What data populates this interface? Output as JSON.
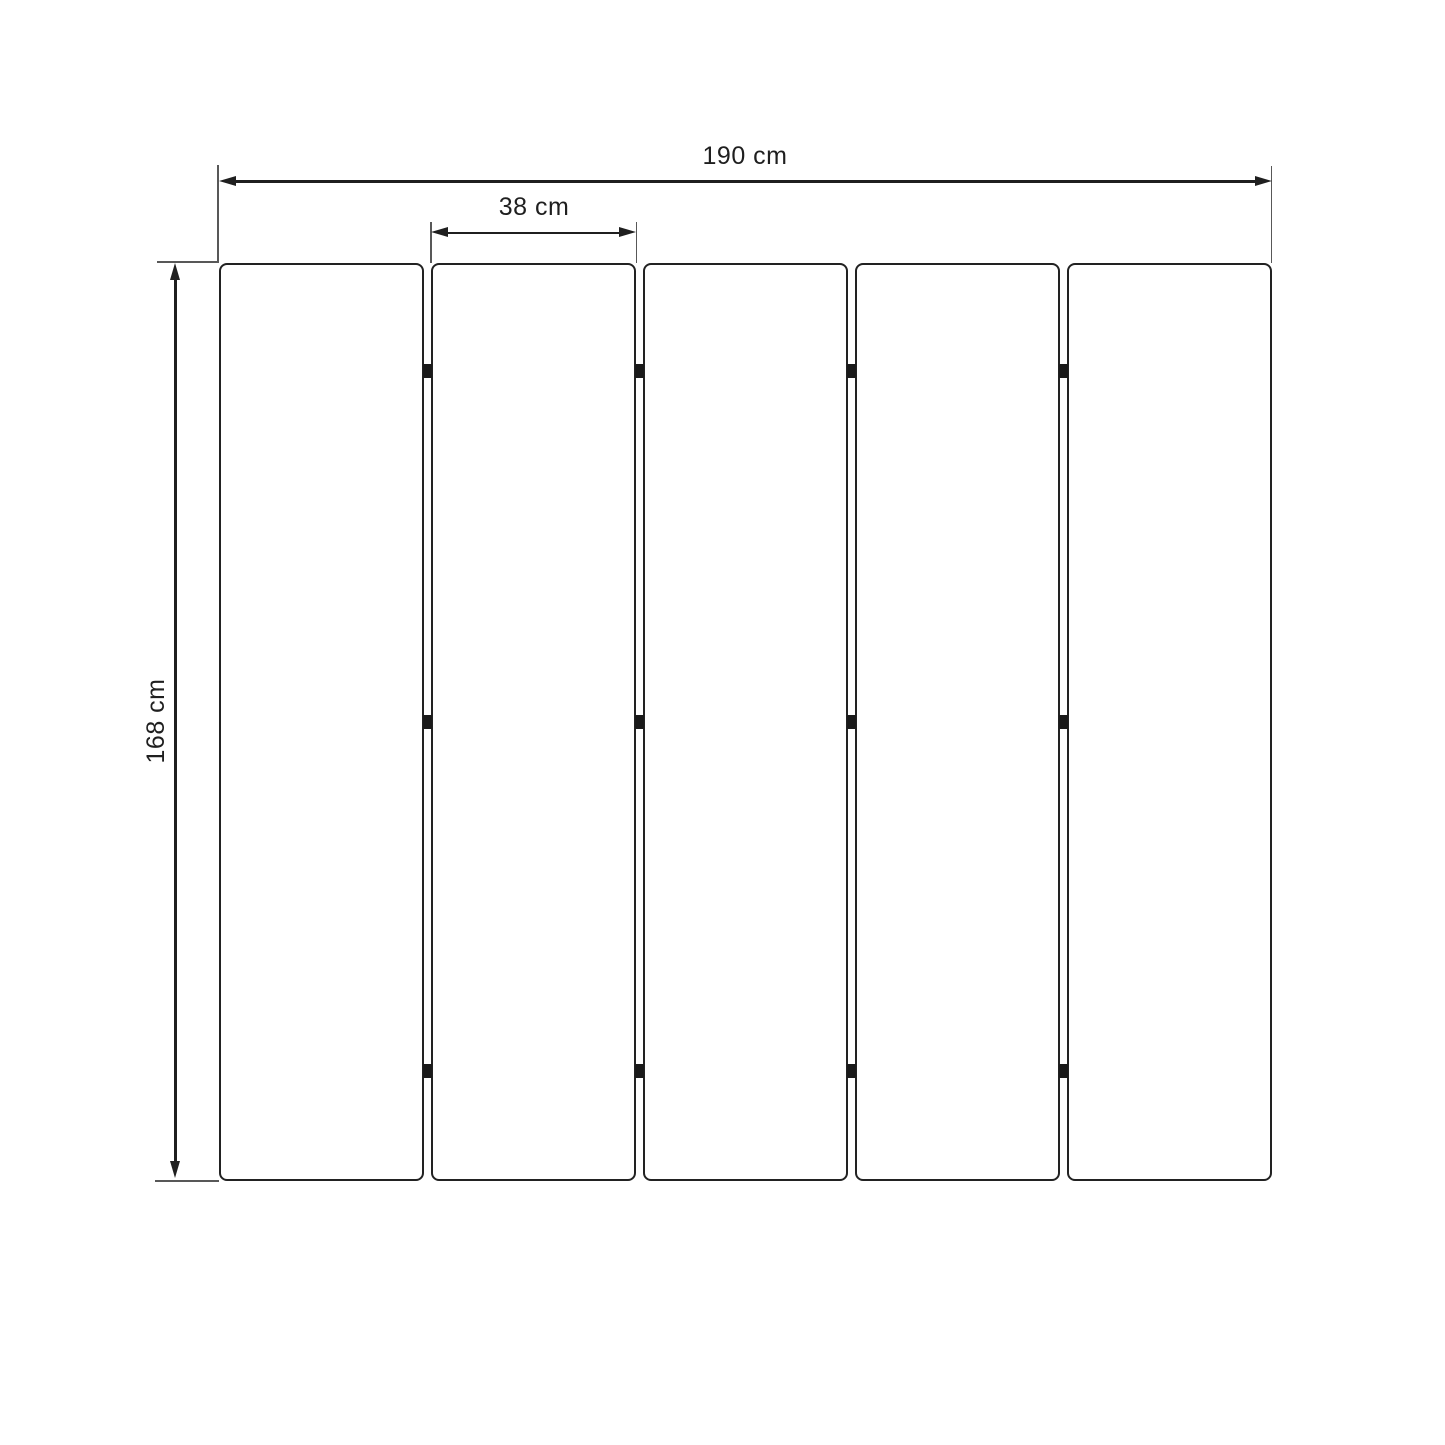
{
  "diagram": {
    "type": "panel-layout-dimension-drawing",
    "panel_count": 5,
    "hinge_rows": 3,
    "dimensions": {
      "total_width": {
        "label": "190 cm",
        "value": 190,
        "unit": "cm"
      },
      "panel_width": {
        "label": "38 cm",
        "value": 38,
        "unit": "cm"
      },
      "height": {
        "label": "168 cm",
        "value": 168,
        "unit": "cm"
      }
    },
    "colors": {
      "background": "#ffffff",
      "panel_border": "#222222",
      "dimension_line": "#1f1f1f",
      "extension_line": "#585858",
      "hinge": "#1a1a1a",
      "text": "#1f1f1f"
    }
  }
}
